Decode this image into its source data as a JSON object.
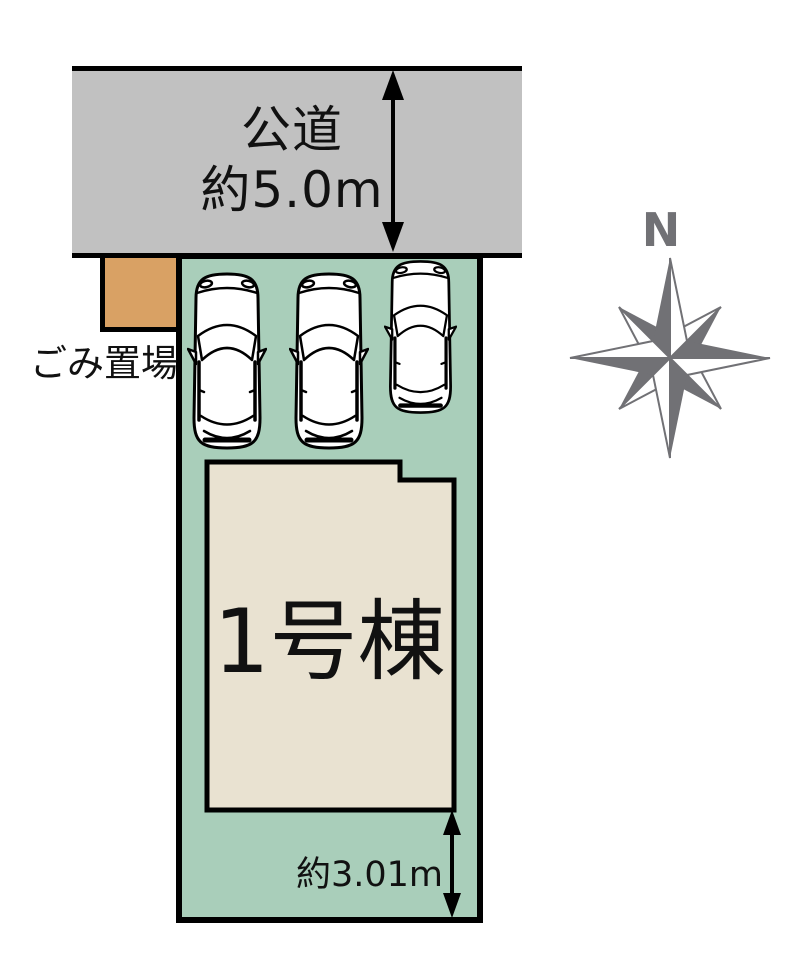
{
  "road": {
    "name_label": "公道",
    "width_label": "約5.0m"
  },
  "garbage_area": {
    "label": "ごみ置場"
  },
  "building": {
    "label": "1号棟"
  },
  "plot": {
    "south_dimension_label": "約3.01m",
    "parked_cars_count": 3
  },
  "compass": {
    "north_label": "N"
  },
  "colors": {
    "road_fill": "#c1c1c1",
    "plot_fill": "#a9ceba",
    "building_fill": "#e9e2d1",
    "garbage_fill": "#d9a164",
    "compass_gray": "#717175",
    "outline_black": "#000000",
    "background": "#ffffff",
    "text_black": "#111111"
  }
}
